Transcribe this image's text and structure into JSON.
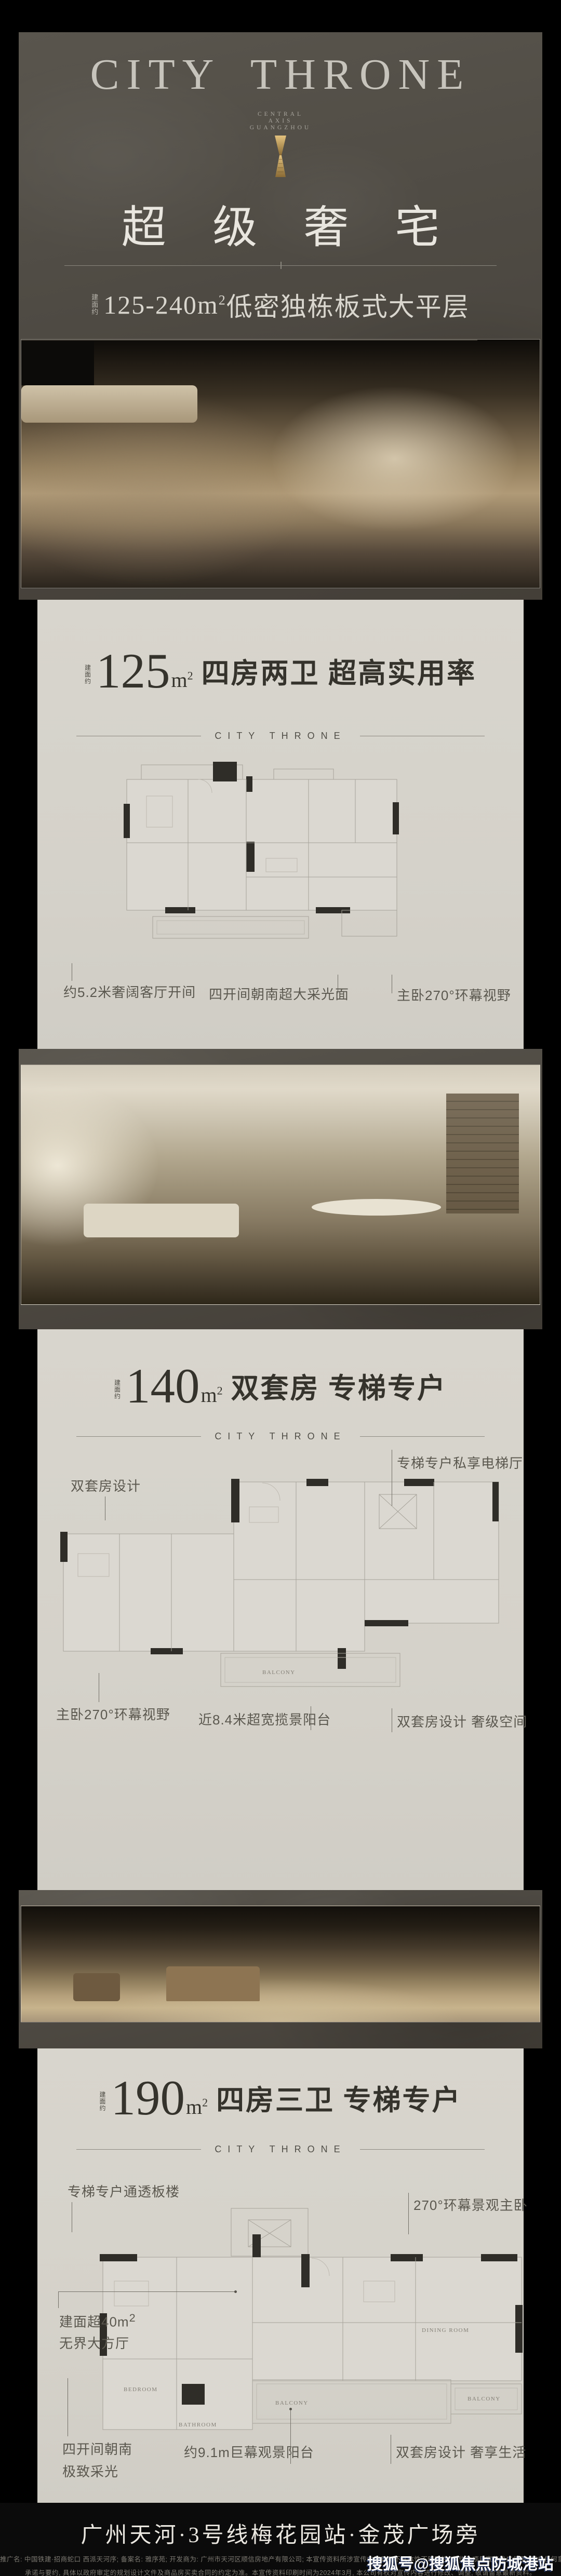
{
  "brand": {
    "title": "CITY THRONE",
    "tagline_line1": "CENTRAL",
    "tagline_line2": "AXIS",
    "tagline_line3": "GUANGZHOU",
    "headline": "超 级 奢 宅",
    "area_prefix": "建面约",
    "area_range": "125-240m",
    "area_sup": "2",
    "area_rest": "低密独栋板式大平层"
  },
  "divider_label": "CITY THRONE",
  "sections": [
    {
      "area_prefix": "建面约",
      "area_number": "125",
      "area_unit": "m",
      "area_sup": "2",
      "title": "四房两卫 超高实用率",
      "annotations": {
        "left": "约5.2米奢阔客厅开间",
        "center": "四开间朝南超大采光面",
        "right": "主卧270°环幕视野"
      }
    },
    {
      "area_prefix": "建面约",
      "area_number": "140",
      "area_unit": "m",
      "area_sup": "2",
      "title": "双套房 专梯专户",
      "annotations": {
        "top_left": "双套房设计",
        "top_right": "专梯专户私享电梯厅",
        "bottom_left": "主卧270°环幕视野",
        "bottom_center": "近8.4米超宽揽景阳台",
        "bottom_right": "双套房设计 奢级空间"
      },
      "rooms": {
        "balcony": "BALCONY"
      }
    },
    {
      "area_prefix": "建面约",
      "area_number": "190",
      "area_unit": "m",
      "area_sup": "2",
      "title": "四房三卫 专梯专户",
      "annotations": {
        "top_left": "专梯专户通透板楼",
        "top_right": "270°环幕景观主卧",
        "mid_left_line1": "建面超40m",
        "mid_left_sup": "2",
        "mid_left_line2": "无界大方厅",
        "bottom_left_line1": "四开间朝南",
        "bottom_left_line2": "极致采光",
        "bottom_center": "约9.1m巨幕观景阳台",
        "bottom_right": "双套房设计 奢享生活"
      },
      "rooms": {
        "dining": "DINING ROOM",
        "bedroom": "BEDROOM",
        "bathroom": "BATHROOM",
        "balcony_main": "BALCONY",
        "balcony_right": "BALCONY"
      }
    }
  ],
  "footer": {
    "headline": "广州天河·3号线梅花园站·金茂广场旁",
    "disclaimer_line1": "推广名: 中国铁建·招商蛇口 西派天河序; 备案名: 雅序苑; 开发商为: 广州市天河区顺信房地产有限公司; 本宣传资料所涉宣传内容具有不具体性不明确性, 仅作为项目宣传推广使用, 不在任何意义上构成开发商的",
    "disclaimer_line2": "承诺与要约, 具体以政府审定的规划设计文件及商品房买卖合同的约定为准。本宣传资料印刷时间为2024年3月, 本公司有权对宣传内容进行修改、调整, 敬请留意最新资料。"
  },
  "watermark": "搜狐号@搜狐焦点防城港站",
  "colors": {
    "accent_gold": "#c79a56",
    "dark_bg": "#4e4a43",
    "light_bg": "#d6d3cb",
    "ink": "#35332d"
  }
}
